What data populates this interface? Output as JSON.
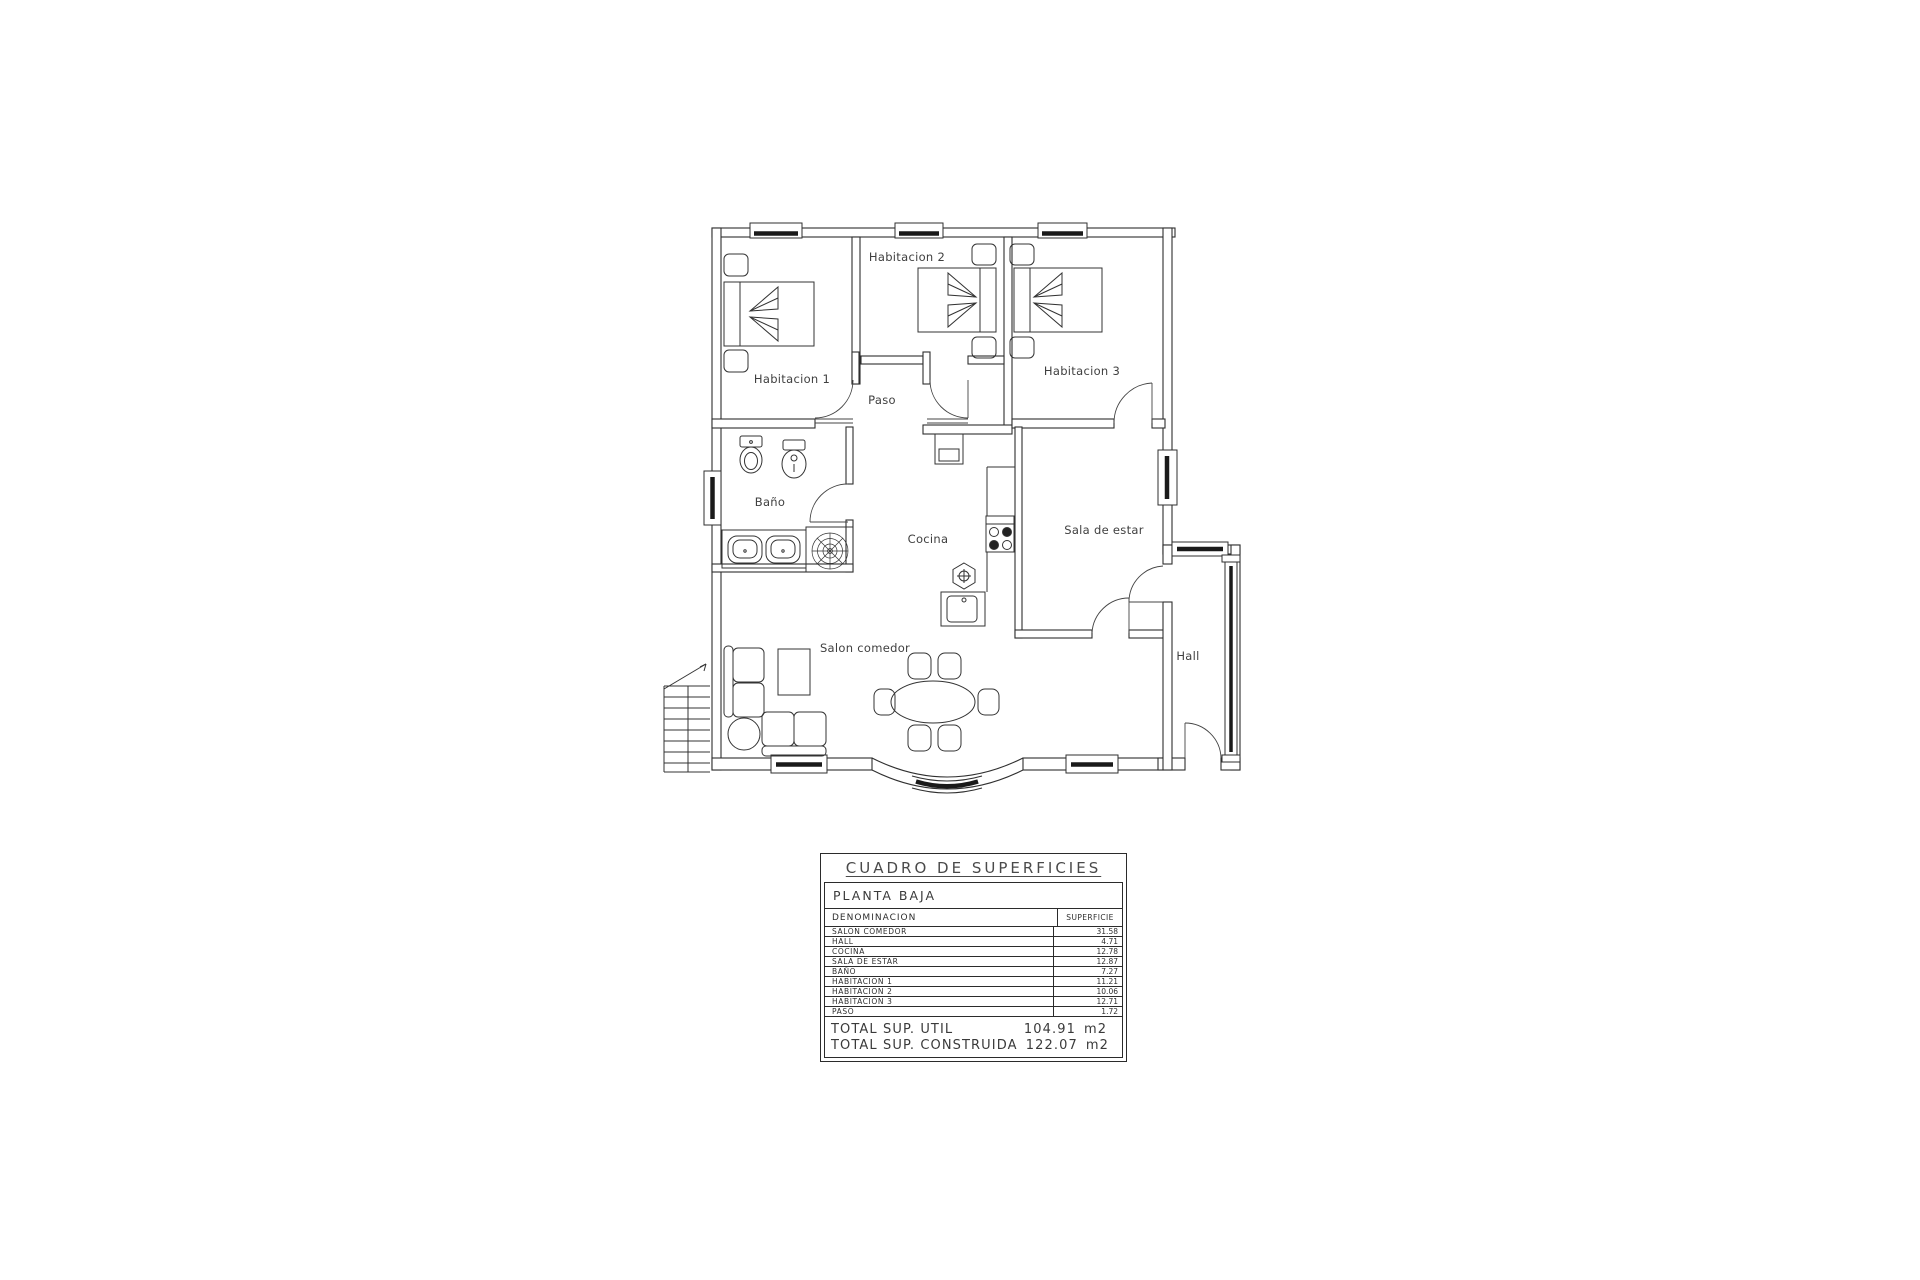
{
  "plan": {
    "rooms": {
      "habitacion_1": "Habitacion 1",
      "habitacion_2": "Habitacion 2",
      "habitacion_3": "Habitacion 3",
      "paso": "Paso",
      "bano": "Baño",
      "cocina": "Cocina",
      "sala_de_estar": "Sala de estar",
      "salon_comedor": "Salon comedor",
      "hall": "Hall"
    },
    "line_color": "#2f2f2f"
  },
  "surface_table": {
    "title": "CUADRO DE SUPERFICIES",
    "floor_label": "PLANTA BAJA",
    "columns": {
      "denominacion": "DENOMINACION",
      "superficie": "SUPERFICIE"
    },
    "rows": [
      {
        "name": "SALON COMEDOR",
        "area": "31.58"
      },
      {
        "name": "HALL",
        "area": "4.71"
      },
      {
        "name": "COCINA",
        "area": "12.78"
      },
      {
        "name": "SALA DE ESTAR",
        "area": "12.87"
      },
      {
        "name": "BAÑO",
        "area": "7.27"
      },
      {
        "name": "HABITACION 1",
        "area": "11.21"
      },
      {
        "name": "HABITACION 2",
        "area": "10.06"
      },
      {
        "name": "HABITACION 3",
        "area": "12.71"
      },
      {
        "name": "PASO",
        "area": "1.72"
      }
    ],
    "totals": [
      {
        "label": "TOTAL SUP. UTIL",
        "value": "104.91",
        "unit": "m2"
      },
      {
        "label": "TOTAL SUP. CONSTRUIDA",
        "value": "122.07",
        "unit": "m2"
      }
    ]
  }
}
